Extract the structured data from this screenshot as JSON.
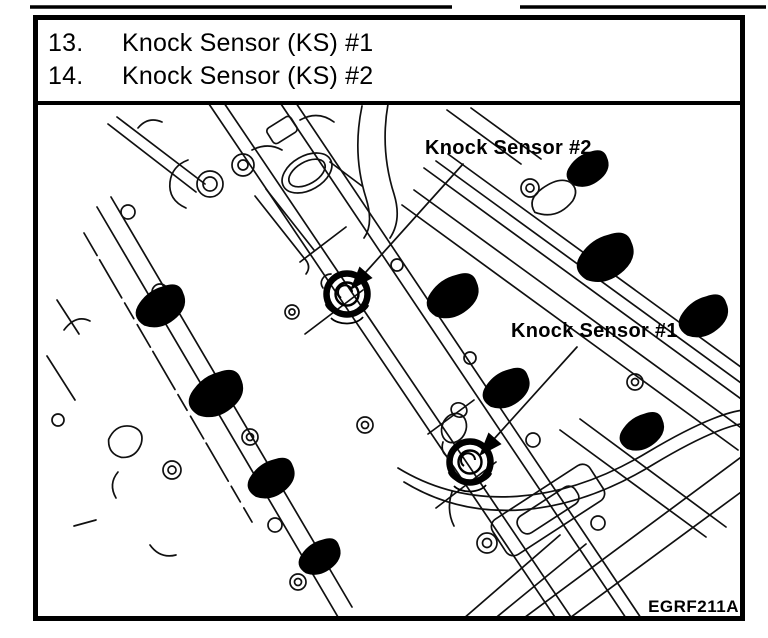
{
  "colors": {
    "ink": "#000000",
    "paper": "#ffffff"
  },
  "title_block": {
    "items": [
      {
        "num": "13.",
        "label": "Knock Sensor (KS) #1"
      },
      {
        "num": "14.",
        "label": "Knock Sensor (KS) #2"
      }
    ]
  },
  "diagram": {
    "callouts": [
      {
        "id": "knock-sensor-2",
        "text": "Knock Sensor #2"
      },
      {
        "id": "knock-sensor-1",
        "text": "Knock Sensor #1"
      }
    ],
    "figure_code": "EGRF211A"
  }
}
